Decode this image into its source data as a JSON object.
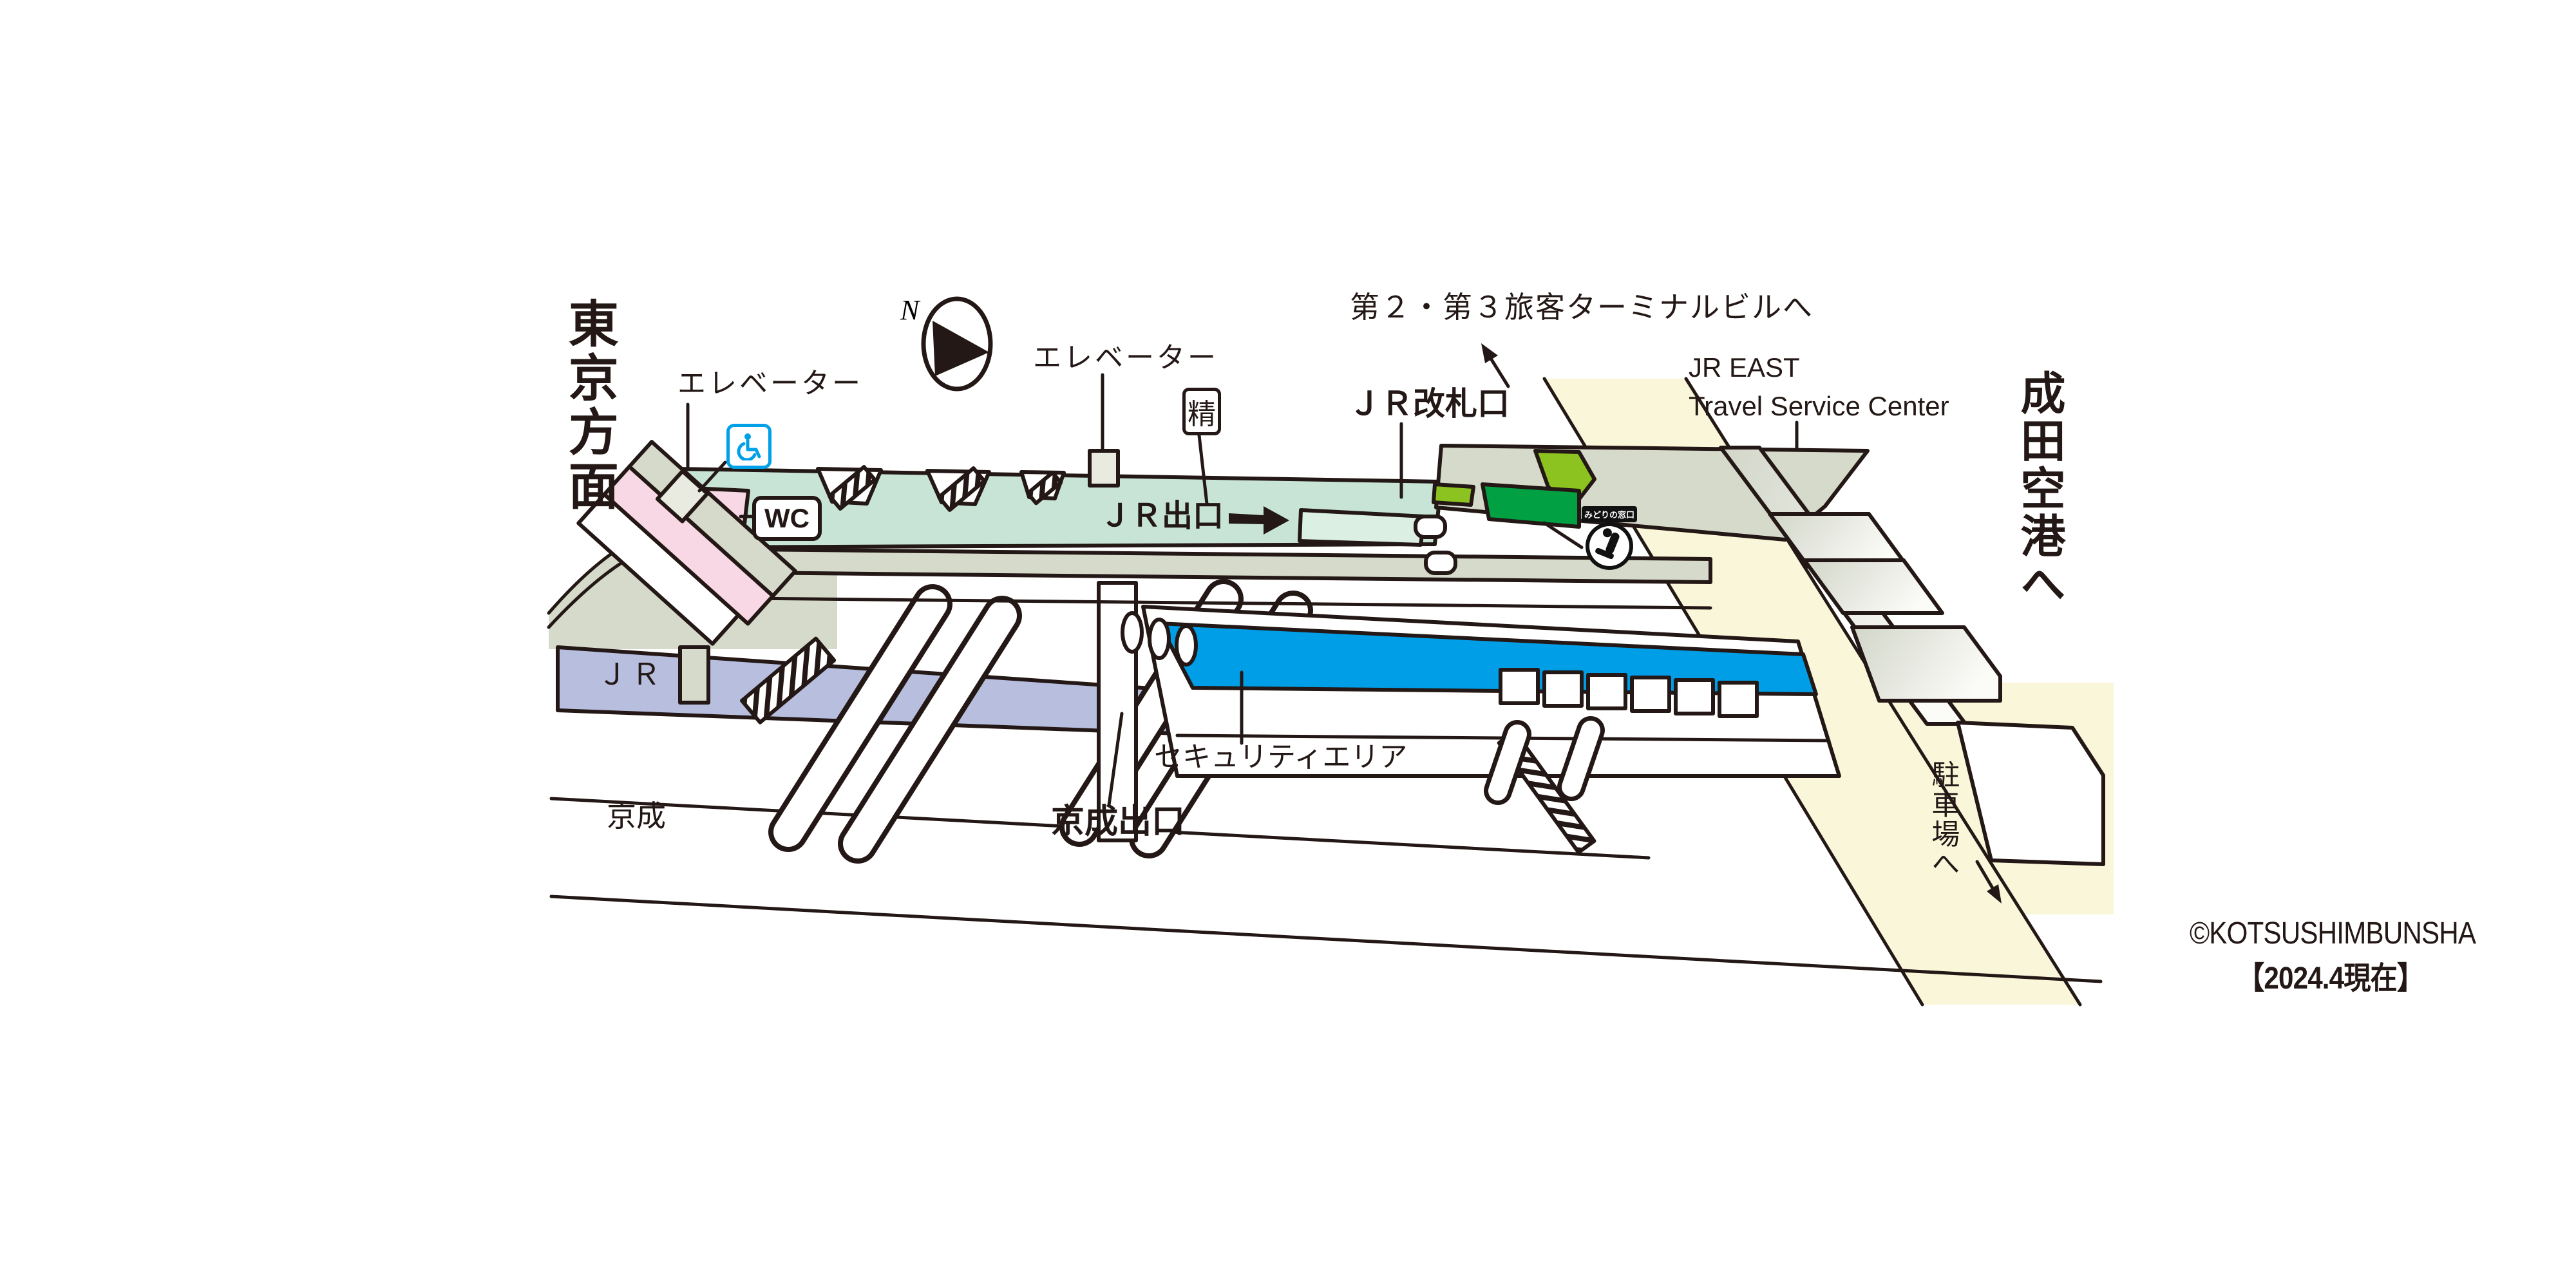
{
  "map": {
    "direction_left": "東京方面",
    "direction_right": "成田空港へ",
    "compass": {
      "north": "N"
    },
    "stations": {
      "jr": "ＪＲ",
      "keisei": "京成"
    },
    "labels": {
      "elevator_left": "エレベーター",
      "elevator_center": "エレベーター",
      "terminal_link": "第２・第３旅客ターミナルビルへ",
      "jr_east_travel_line1": "JR EAST",
      "jr_east_travel_line2": "Travel Service Center",
      "jr_gate": "ＪＲ改札口",
      "jr_exit": "ＪＲ出口",
      "keisei_exit": "京成出口",
      "security_area": "セキュリティエリア",
      "parking": "駐車場へ"
    },
    "badges": {
      "wc": "WC",
      "fare_adjustment": "精",
      "midori_no_madoguchi": "みどりの窓口"
    },
    "footer": {
      "credit": "©KOTSUSHIMBUNSHA",
      "date_note": "【2024.4現在】"
    },
    "colors": {
      "line": "#231815",
      "concourse_mint": "#c8e4d6",
      "concourse_mint_light": "#dcefe3",
      "roof_gray": "#d6dacb",
      "jr_platform_lavender": "#b7bede",
      "security_blue": "#009ee6",
      "walkway_cream": "#faf6da",
      "restroom_pink": "#f8d8e4",
      "midori_green_light": "#8cc320",
      "midori_green_dark": "#00a043",
      "accessible_blue": "#00a0e9"
    }
  }
}
